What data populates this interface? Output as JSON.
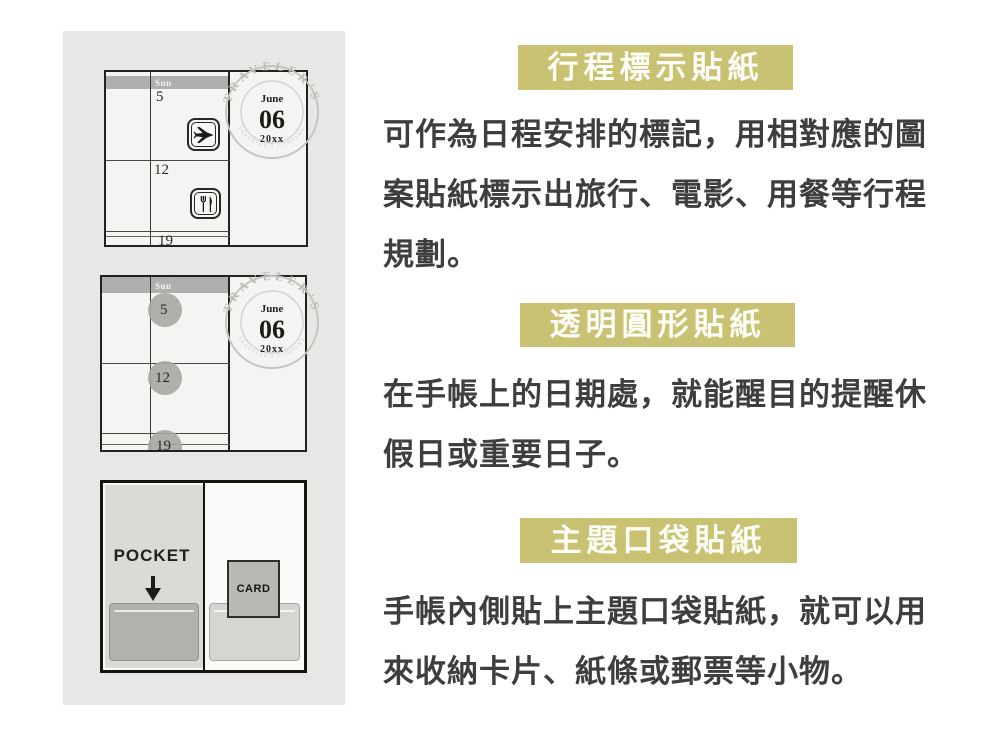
{
  "colors": {
    "accent_olive": "#c9c272",
    "paper_gray": "#e8e7e5",
    "ink": "#3e3e3e"
  },
  "stamp": {
    "ring_text": "TRAVELER'S",
    "sub_text": "TRAVELER'S COMPANY",
    "month": "June",
    "day": "06",
    "year": "20xx"
  },
  "calendar_top": {
    "day_header": "Sun",
    "dates": [
      "5",
      "12",
      "19"
    ]
  },
  "calendar_mid": {
    "day_header": "Sun",
    "dates": [
      "5",
      "12",
      "19"
    ]
  },
  "pocket_diagram": {
    "pocket_label": "POCKET",
    "card_label": "CARD"
  },
  "sections": [
    {
      "title": "行程標示貼紙",
      "lines": [
        "可作為日程安排的標記，用相對應的圖",
        "案貼紙標示出旅行、電影、用餐等行程",
        "規劃。"
      ]
    },
    {
      "title": "透明圓形貼紙",
      "lines": [
        "在手帳上的日期處，就能醒目的提醒休",
        "假日或重要日子。"
      ]
    },
    {
      "title": "主題口袋貼紙",
      "lines": [
        "手帳內側貼上主題口袋貼紙，就可以用",
        "來收納卡片、紙條或郵票等小物。"
      ]
    }
  ]
}
